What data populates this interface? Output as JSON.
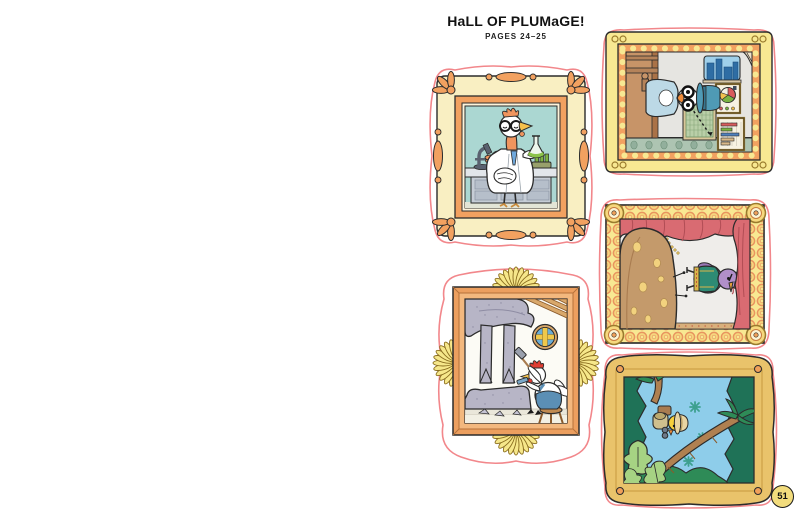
{
  "page": {
    "title": "HaLL OF PLUMaGE!",
    "subtitle": "PAGES 24–25",
    "page_number": "51"
  },
  "stickers": [
    {
      "name": "scientist-bird-portrait",
      "description": "Rooster scientist with round glasses and lab coat holding a green flask beside a microscope and test tubes, inside an ornate baroque cream-and-orange frame",
      "orientation": "portrait"
    },
    {
      "name": "statistician-bird",
      "description": "Bird in a blue top hat and thick round glasses posed in a study with pie chart, grid chart and bar chart on the wall, inside a scalloped gold frame; picture rotated 90 degrees",
      "orientation": "landscape"
    },
    {
      "name": "opera-bird-on-stage",
      "description": "Purple bird in a green vest singing on stage beside a giant spotted loaf under red curtains with a gold chain, inside a ring-patterned gold frame; picture rotated 90 degrees",
      "orientation": "landscape"
    },
    {
      "name": "sculptor-hen",
      "description": "White hen with red comb chiselling a giant speckled stone statue of bird legs beneath a round window, inside an orange frame with yellow petal fans",
      "orientation": "portrait"
    },
    {
      "name": "explorer-chick-jungle",
      "description": "Yellow chick explorer wearing a pith helmet with binoculars and backpack among jungle palms, inside a wavy gold frame with oval medallions; picture rotated 90 degrees",
      "orientation": "landscape"
    }
  ],
  "palette": {
    "sticker_outline_pink": "#f2878b",
    "frame_gold": "#f8e892",
    "frame_orange": "#f2a160",
    "frame_cream": "#f9efc2",
    "lab_teal": "#abd7d2",
    "curtain_red": "#d96b72",
    "jungle_green": "#1f7257",
    "sky_blue": "#8ecdea",
    "badge_yellow": "#f2dc7d",
    "ink": "#2b2b2b"
  }
}
